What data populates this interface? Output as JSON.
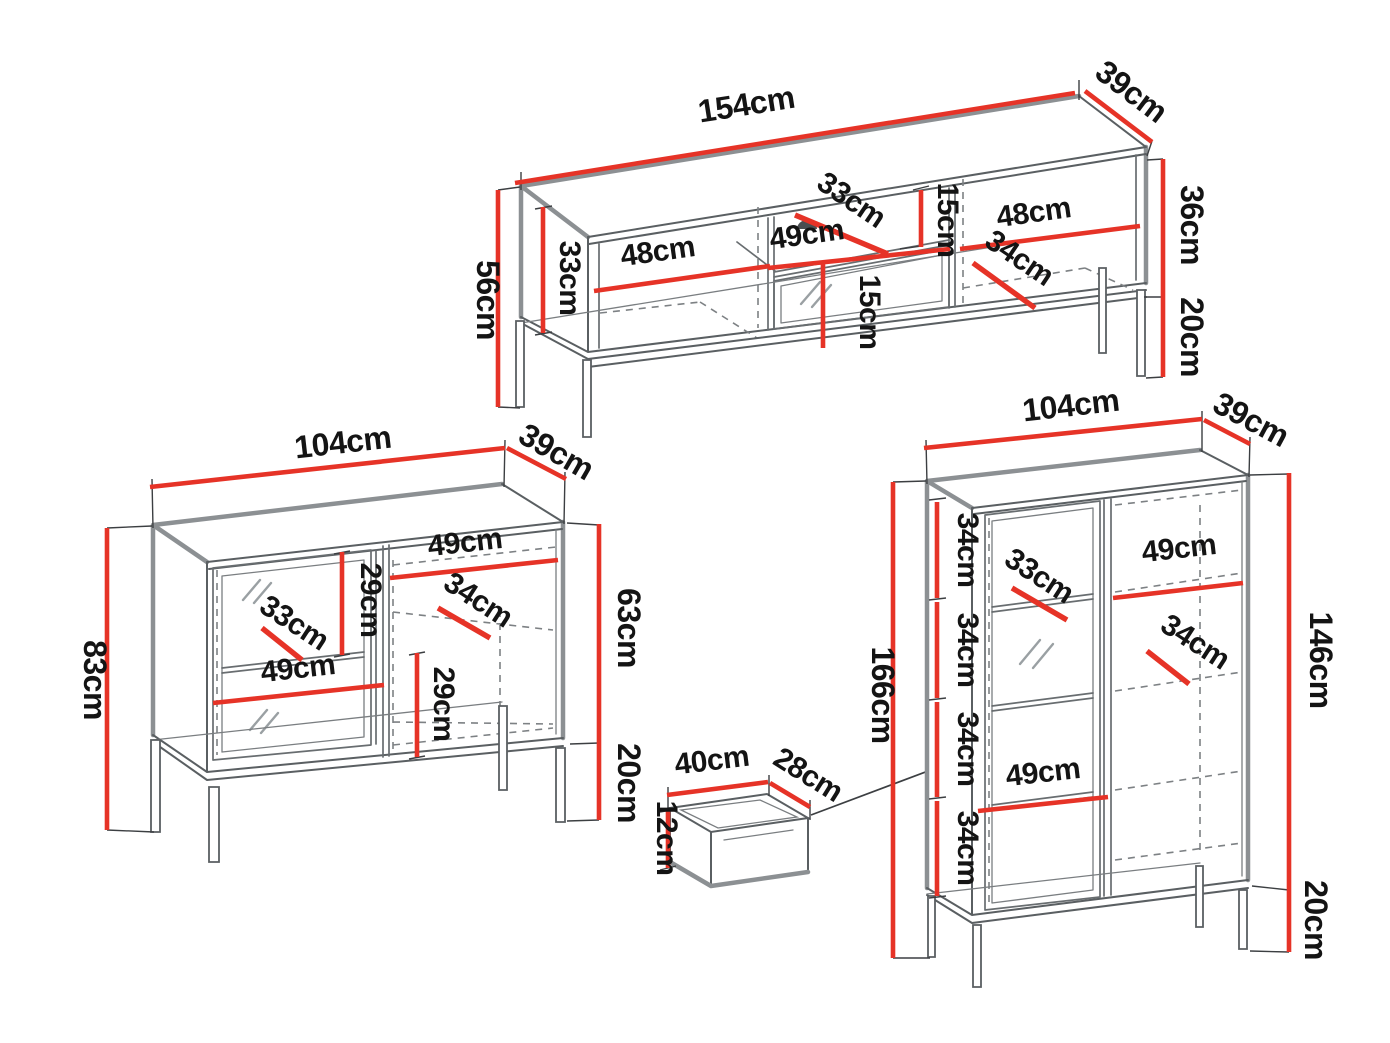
{
  "diagram": {
    "title": "furniture-dimensions-diagram",
    "background": "#ffffff",
    "accent_red": "#e63327",
    "outline_gray": "#8c9093",
    "ink": "#141414",
    "unit": "cm"
  },
  "tv_stand": {
    "name": "tv-stand",
    "dims": {
      "width": "154cm",
      "depth": "39cm",
      "total_height": "56cm",
      "interior_height": "33cm",
      "left_compartment_width": "48cm",
      "center_compartment_width": "49cm",
      "center_shelf_depth": "33cm",
      "upper_niche_height": "15cm",
      "lower_niche_height": "15cm",
      "right_compartment_width": "48cm",
      "right_shelf_depth": "34cm",
      "carcass_height": "36cm",
      "leg_height": "20cm"
    }
  },
  "sideboard": {
    "name": "sideboard",
    "dims": {
      "width": "104cm",
      "depth": "39cm",
      "total_height": "83cm",
      "upper_section_height": "29cm",
      "left_shelf_depth": "33cm",
      "right_compartment_width": "49cm",
      "right_shelf_depth": "34cm",
      "left_compartment_width": "49cm",
      "lower_section_height": "29cm",
      "carcass_height": "63cm",
      "leg_height": "20cm"
    }
  },
  "drawer": {
    "name": "drawer",
    "dims": {
      "width": "40cm",
      "depth": "28cm",
      "height": "12cm"
    }
  },
  "display_cabinet": {
    "name": "display-cabinet",
    "dims": {
      "width": "104cm",
      "depth": "39cm",
      "total_height": "166cm",
      "section_heights": [
        "34cm",
        "34cm",
        "34cm",
        "34cm"
      ],
      "left_shelf_depth": "33cm",
      "upper_shelf_width": "49cm",
      "right_shelf_depth": "34cm",
      "lower_shelf_width": "49cm",
      "carcass_height": "146cm",
      "leg_height": "20cm"
    }
  }
}
